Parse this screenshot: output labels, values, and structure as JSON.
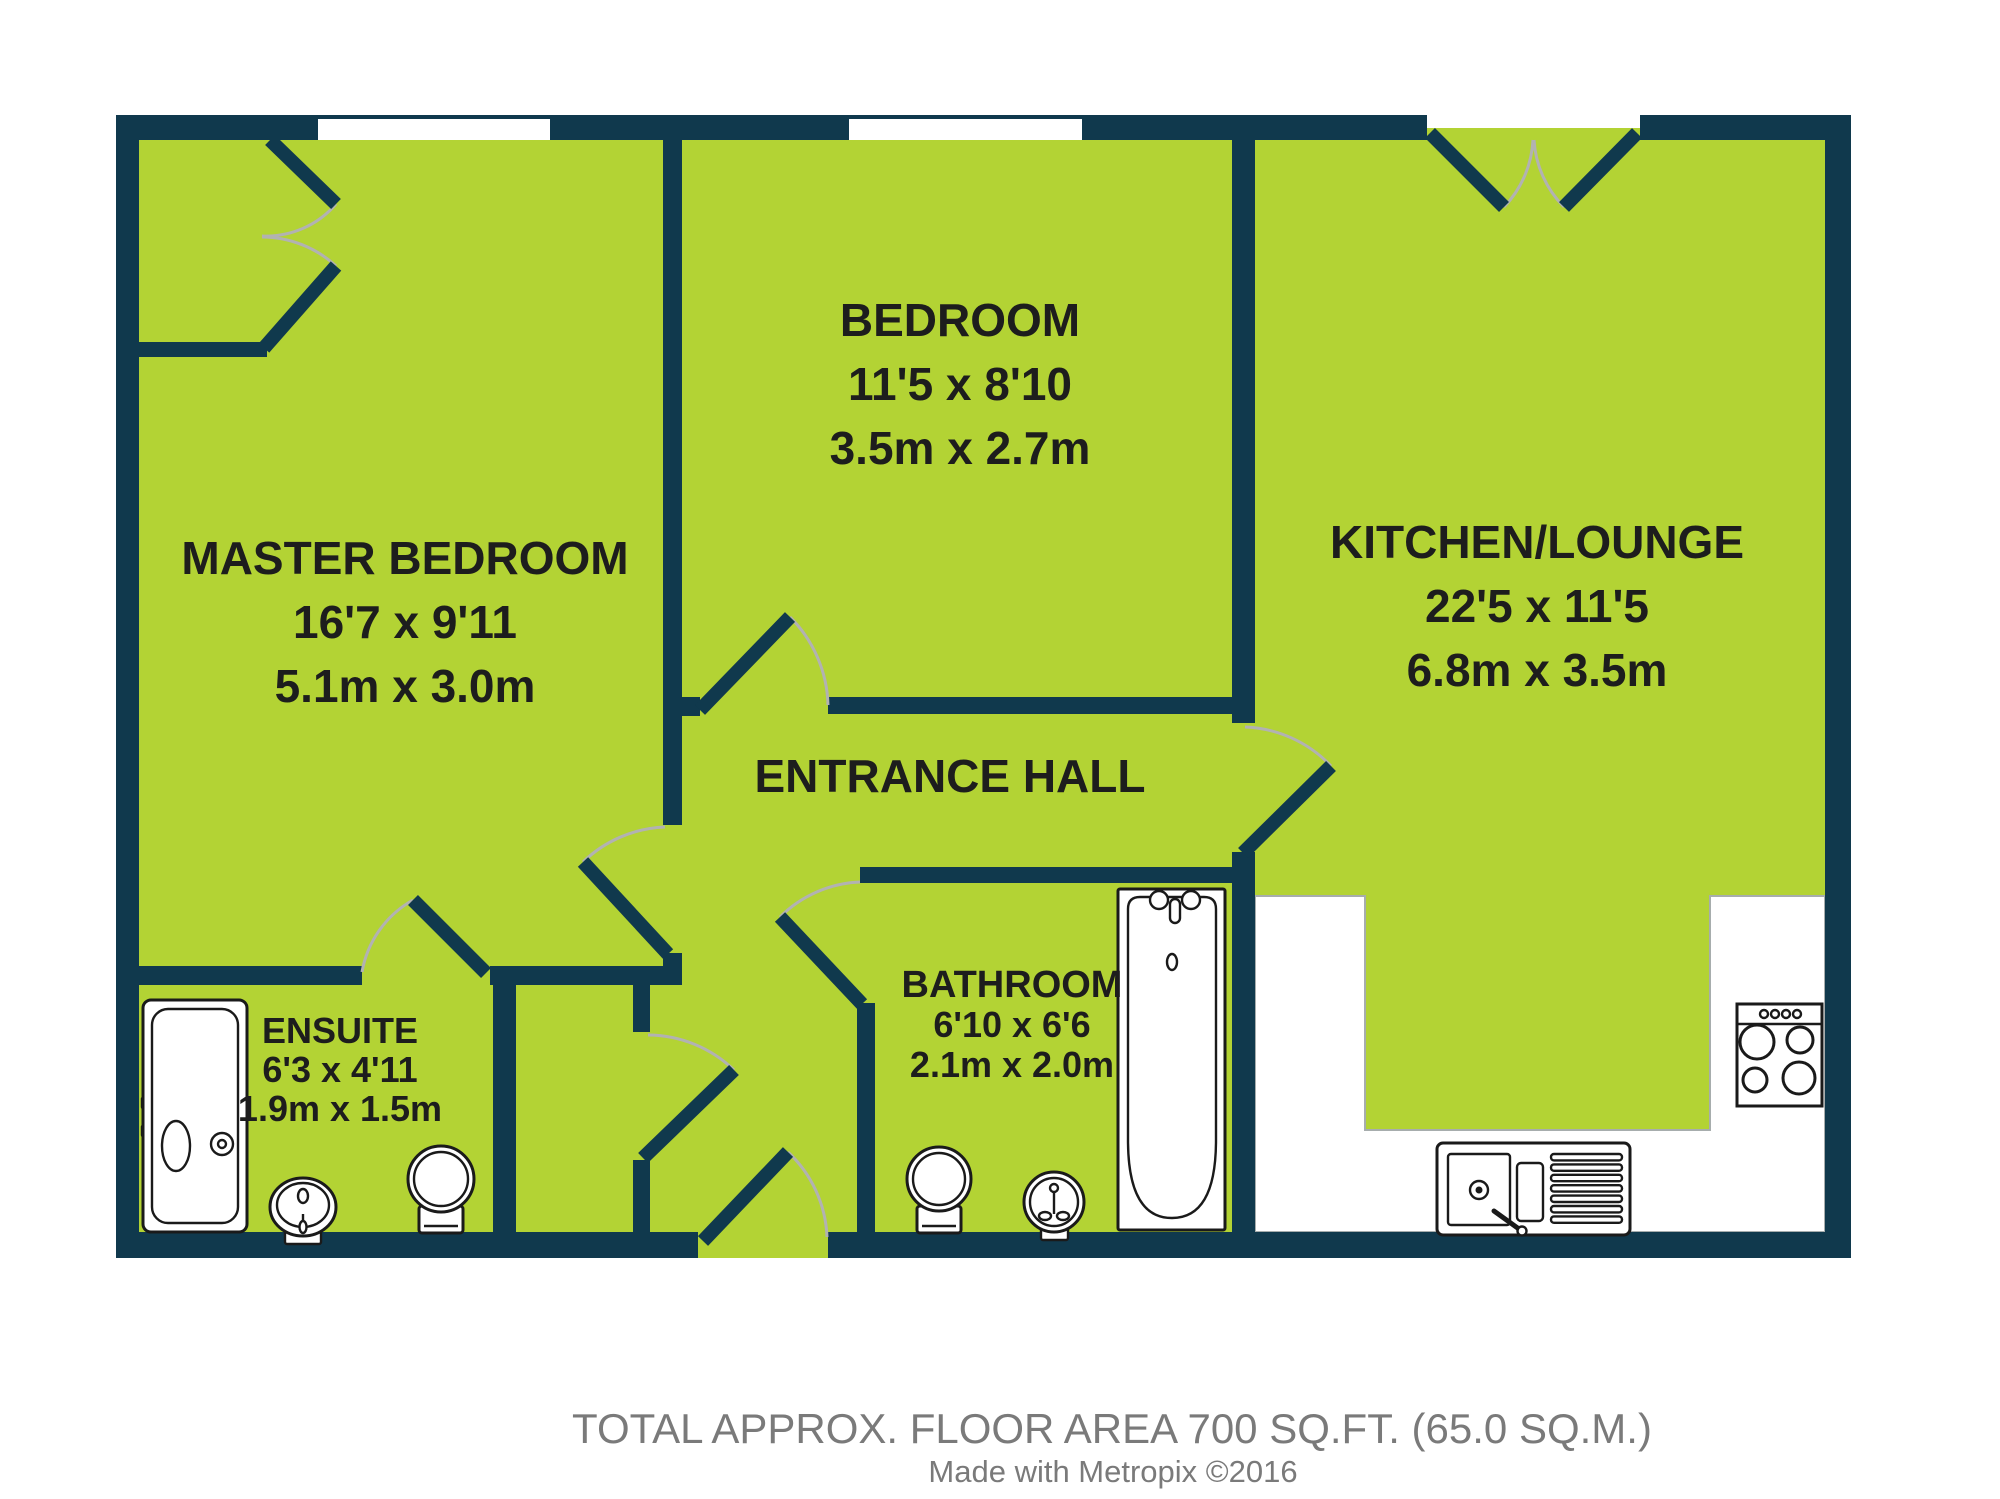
{
  "palette": {
    "wall": "#10394d",
    "floor": "#b3d334",
    "door_arc": "#b2b2b2",
    "counter_outline": "#a7adad",
    "fixture_outline": "#1a1a1a",
    "label_text": "#1d1d1d",
    "footer_text": "#7a7a7a",
    "window_fill": "#ffffff"
  },
  "rooms": [
    {
      "id": "master-bedroom",
      "name": "MASTER BEDROOM",
      "size_imperial": "16'7 x 9'11",
      "size_metric": "5.1m x 3.0m"
    },
    {
      "id": "bedroom",
      "name": "BEDROOM",
      "size_imperial": "11'5 x 8'10",
      "size_metric": "3.5m x 2.7m"
    },
    {
      "id": "kitchen-lounge",
      "name": "KITCHEN/LOUNGE",
      "size_imperial": "22'5 x 11'5",
      "size_metric": "6.8m x 3.5m"
    },
    {
      "id": "entrance-hall",
      "name": "ENTRANCE HALL"
    },
    {
      "id": "bathroom",
      "name": "BATHROOM",
      "size_imperial": "6'10 x 6'6",
      "size_metric": "2.1m x 2.0m"
    },
    {
      "id": "ensuite",
      "name": "ENSUITE",
      "size_imperial": "6'3 x 4'11",
      "size_metric": "1.9m x 1.5m"
    }
  ],
  "footer": {
    "line1": "TOTAL APPROX. FLOOR AREA 700 SQ.FT. (65.0 SQ.M.)",
    "line2": "Made with Metropix ©2016"
  }
}
